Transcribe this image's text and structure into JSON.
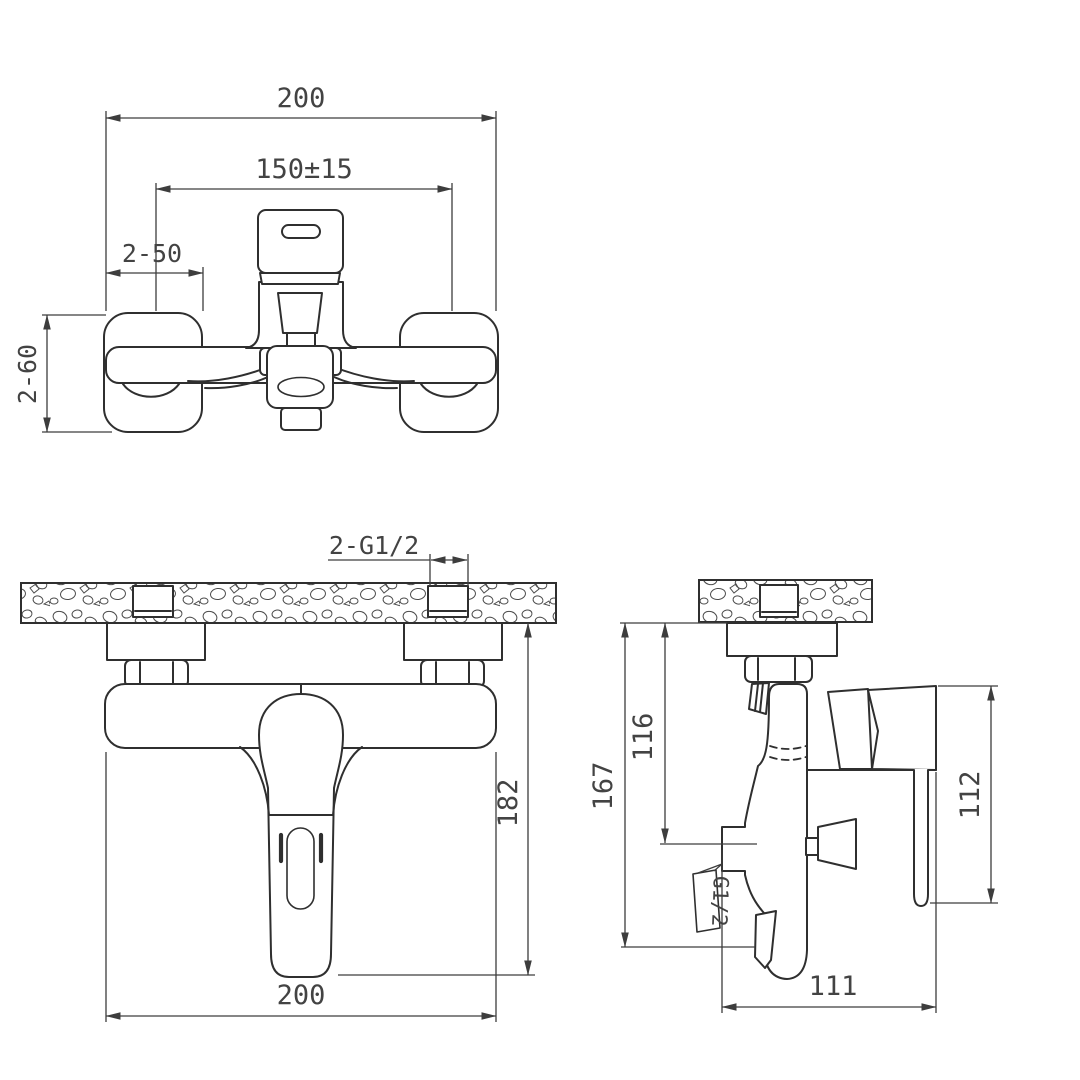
{
  "drawing_title": "wall-mounted bath shower mixer installation dimensions",
  "colors": {
    "line": "#2f2f2f",
    "dimension": "#3d3d3d",
    "text": "#434343",
    "background": "#ffffff"
  },
  "views": {
    "front_detached": {
      "name": "front view detached",
      "dims": {
        "overall_width": "200",
        "mounting_spacing": "150±15",
        "escutcheon_width": "2-50",
        "escutcheon_height": "2-60"
      }
    },
    "front_installed": {
      "name": "front view installed on wall",
      "dims": {
        "inlet_thread": "2-G1/2",
        "height_below_wall": "182",
        "overall_width": "200"
      }
    },
    "side_installed": {
      "name": "side view installed on wall",
      "dims": {
        "overall_height": "167",
        "wall_to_diverter": "116",
        "handle_drop": "112",
        "depth": "111",
        "outlet_thread": "G1/2"
      }
    }
  }
}
